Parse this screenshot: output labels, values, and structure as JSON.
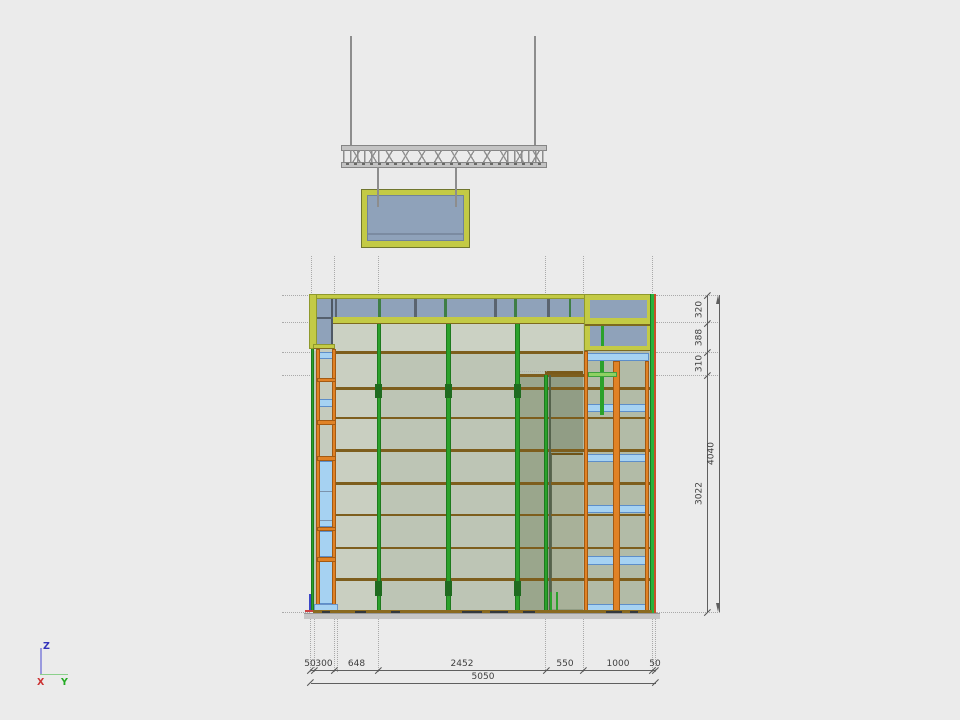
{
  "view": {
    "background_color": "#ebebeb",
    "type_hint": "cad-elevation-viewport"
  },
  "dims": {
    "right": {
      "segments": [
        "320",
        "388",
        "310",
        "3022"
      ],
      "total": "4040"
    },
    "bottom": {
      "segments": [
        "50",
        "300",
        "648",
        "2452",
        "550",
        "1000",
        "50"
      ],
      "total": "5050"
    }
  },
  "axes": {
    "z": "Z",
    "x": "X",
    "y": "Y"
  },
  "colors": {
    "frame_yellow": "#c3ca45",
    "glazing_blue": "#8fa2ba",
    "panel_green_gray": "#bdc5b5",
    "mullion_green": "#2ba12b",
    "post_orange": "#e08226",
    "rail_brown": "#7d5e1d",
    "shelf_blue": "#a6d2f2",
    "edge_red": "#c8502a",
    "axis_z": "#3333bb",
    "axis_x": "#cc3333",
    "axis_y": "#22aa22",
    "dimension_gray": "#3e3e3e"
  }
}
